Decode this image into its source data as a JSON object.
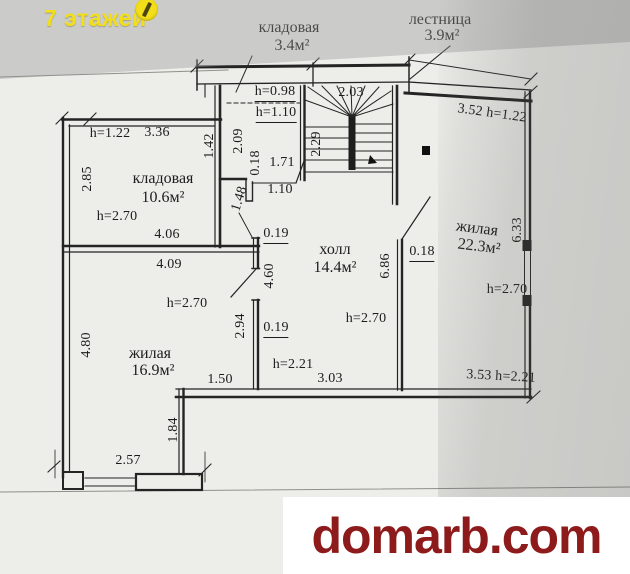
{
  "badge": {
    "label": "7 этажей",
    "color": "#f2de19",
    "icon": "floors-logo-icon"
  },
  "watermark": {
    "text": "domarb.com",
    "color": "#8e1b1b",
    "bg": "#ffffff"
  },
  "plan": {
    "line_color": "#242424",
    "rooms": [
      {
        "name": "кладовая",
        "area": "3.4м²",
        "cx": 289,
        "cy": 28,
        "acx": 292,
        "acy": 46,
        "rot": 0
      },
      {
        "name": "лестница",
        "area": "3.9м²",
        "cx": 440,
        "cy": 20,
        "acx": 442,
        "acy": 36,
        "rot": 0
      },
      {
        "name": "кладовая",
        "area": "10.6м²",
        "cx": 163,
        "cy": 179,
        "acx": 163,
        "acy": 198,
        "rot": 0
      },
      {
        "name": "холл",
        "area": "14.4м²",
        "cx": 335,
        "cy": 250,
        "acx": 335,
        "acy": 268,
        "rot": 0
      },
      {
        "name": "жилая",
        "area": "22.3м²",
        "cx": 477,
        "cy": 229,
        "acx": 479,
        "acy": 247,
        "rot": 7
      },
      {
        "name": "жилая",
        "area": "16.9м²",
        "cx": 150,
        "cy": 354,
        "acx": 153,
        "acy": 371,
        "rot": 0
      }
    ],
    "dimensions": [
      {
        "text": "h=0.98",
        "cx": 275,
        "cy": 93,
        "u": true
      },
      {
        "text": "h=1.10",
        "cx": 276,
        "cy": 114,
        "u": true
      },
      {
        "text": "2.03",
        "cx": 351,
        "cy": 93
      },
      {
        "text": "2.29",
        "cx": 317,
        "cy": 144,
        "rot": -90
      },
      {
        "text": "3.52 h=1.22",
        "cx": 492,
        "cy": 114,
        "rot": 8
      },
      {
        "text": "h=1.22",
        "cx": 110,
        "cy": 134
      },
      {
        "text": "3.36",
        "cx": 157,
        "cy": 133
      },
      {
        "text": "1.42",
        "cx": 210,
        "cy": 146,
        "rot": -90
      },
      {
        "text": "2.09",
        "cx": 239,
        "cy": 141,
        "rot": -90
      },
      {
        "text": "0.18",
        "cx": 256,
        "cy": 163,
        "rot": -90
      },
      {
        "text": "1.71",
        "cx": 282,
        "cy": 163
      },
      {
        "text": "1.10",
        "cx": 280,
        "cy": 190
      },
      {
        "text": "1.48",
        "cx": 240,
        "cy": 199,
        "rot": -72
      },
      {
        "text": "2.85",
        "cx": 88,
        "cy": 179,
        "rot": -90
      },
      {
        "text": "h=2.70",
        "cx": 117,
        "cy": 217
      },
      {
        "text": "4.06",
        "cx": 167,
        "cy": 235
      },
      {
        "text": "0.19",
        "cx": 276,
        "cy": 235,
        "u": true
      },
      {
        "text": "4.60",
        "cx": 270,
        "cy": 276,
        "rot": -90
      },
      {
        "text": "4.09",
        "cx": 169,
        "cy": 265
      },
      {
        "text": "6.86",
        "cx": 386,
        "cy": 266,
        "rot": -90
      },
      {
        "text": "0.18",
        "cx": 422,
        "cy": 253,
        "u": true
      },
      {
        "text": "6.33",
        "cx": 518,
        "cy": 230,
        "rot": -90
      },
      {
        "text": "h=2.70",
        "cx": 507,
        "cy": 290
      },
      {
        "text": "h=2.70",
        "cx": 366,
        "cy": 319
      },
      {
        "text": "h=2.70",
        "cx": 187,
        "cy": 304
      },
      {
        "text": "4.80",
        "cx": 87,
        "cy": 345,
        "rot": -90
      },
      {
        "text": "2.94",
        "cx": 241,
        "cy": 326,
        "rot": -90
      },
      {
        "text": "0.19",
        "cx": 276,
        "cy": 329,
        "u": true
      },
      {
        "text": "1.50",
        "cx": 220,
        "cy": 380
      },
      {
        "text": "h=2.21",
        "cx": 293,
        "cy": 365
      },
      {
        "text": "3.03",
        "cx": 330,
        "cy": 379
      },
      {
        "text": "3.53 h=2.21",
        "cx": 501,
        "cy": 377,
        "rot": 3
      },
      {
        "text": "1.84",
        "cx": 174,
        "cy": 430,
        "rot": -90
      },
      {
        "text": "2.57",
        "cx": 128,
        "cy": 461
      }
    ]
  }
}
